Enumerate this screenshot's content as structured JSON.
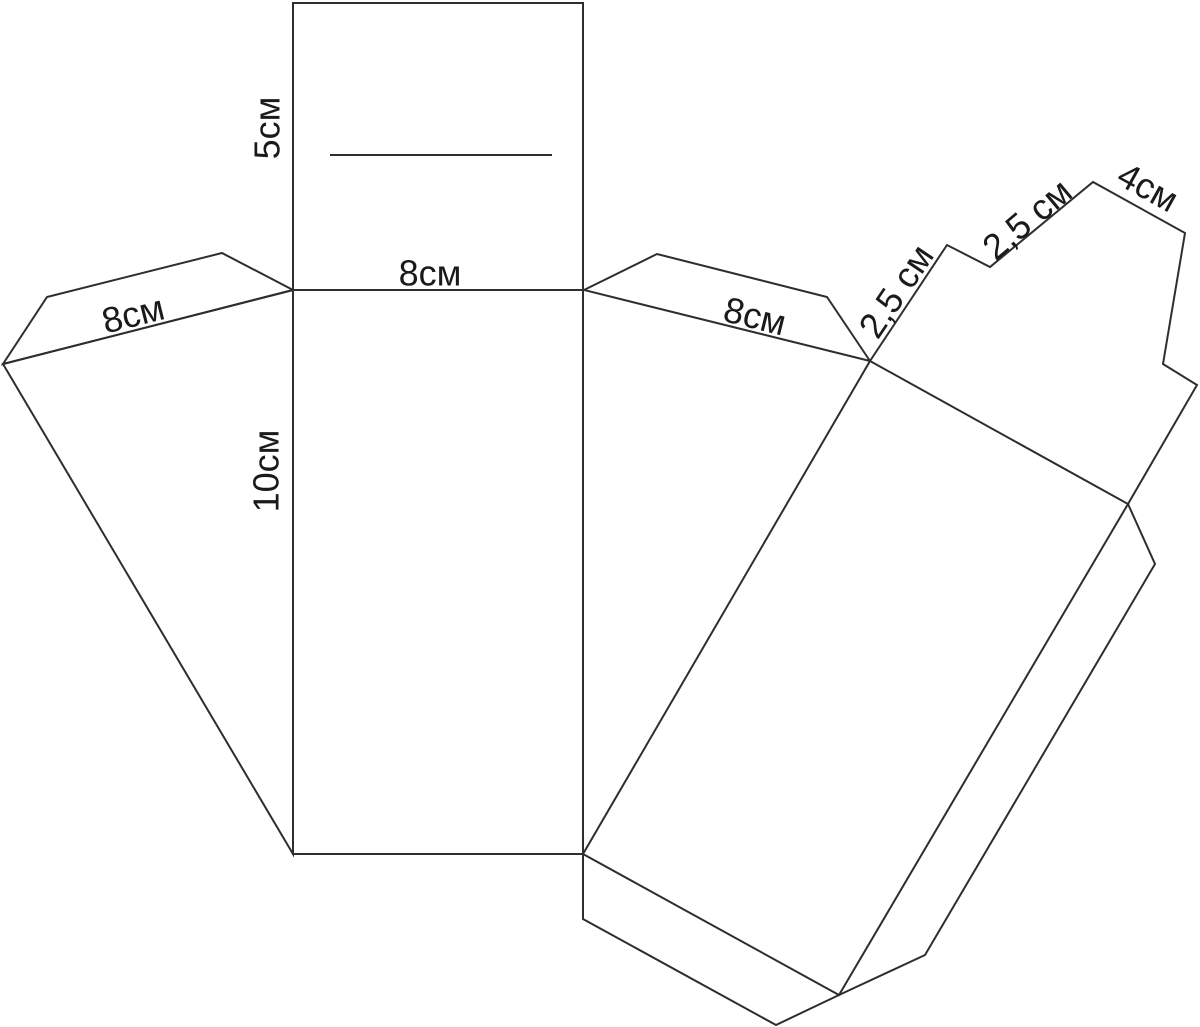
{
  "diagram": {
    "kind": "box-net-pattern",
    "background": "#ffffff"
  },
  "colors": {
    "line": "#2e2e2e",
    "text": "#1a1a1a"
  },
  "stroke_width": 2,
  "canvas": {
    "width": 1200,
    "height": 1027
  },
  "shapes": [
    {
      "name": "lid-panel",
      "type": "polygon",
      "points": [
        [
          293,
          3
        ],
        [
          583,
          3
        ],
        [
          583,
          290
        ],
        [
          293,
          290
        ]
      ]
    },
    {
      "name": "slot-line",
      "type": "polyline",
      "points": [
        [
          330,
          155
        ],
        [
          552,
          155
        ]
      ]
    },
    {
      "name": "front-panel",
      "type": "polygon",
      "points": [
        [
          293,
          290
        ],
        [
          583,
          290
        ],
        [
          583,
          854
        ],
        [
          293,
          854
        ]
      ]
    },
    {
      "name": "left-glue-flap",
      "type": "polygon",
      "points": [
        [
          293,
          290
        ],
        [
          222,
          253
        ],
        [
          47,
          297
        ],
        [
          3,
          364
        ]
      ]
    },
    {
      "name": "left-side-panel",
      "type": "polygon",
      "points": [
        [
          293,
          290
        ],
        [
          3,
          364
        ],
        [
          293,
          854
        ]
      ]
    },
    {
      "name": "right-glue-flap",
      "type": "polygon",
      "points": [
        [
          584,
          290
        ],
        [
          657,
          254
        ],
        [
          827,
          297
        ],
        [
          870,
          361
        ]
      ]
    },
    {
      "name": "back-panel",
      "type": "polygon",
      "points": [
        [
          870,
          361
        ],
        [
          1128,
          504
        ],
        [
          839,
          995
        ],
        [
          583,
          854
        ]
      ]
    },
    {
      "name": "top-edge-strip",
      "type": "polyline",
      "points": [
        [
          870,
          361
        ],
        [
          947,
          245
        ],
        [
          990,
          267
        ],
        [
          1093,
          182
        ],
        [
          1185,
          233
        ],
        [
          1163,
          364
        ],
        [
          1197,
          385
        ],
        [
          1128,
          504
        ]
      ]
    },
    {
      "name": "bottom-edge-strip",
      "type": "polyline",
      "points": [
        [
          1128,
          504
        ],
        [
          1155,
          564
        ],
        [
          925,
          955
        ],
        [
          839,
          995
        ]
      ]
    },
    {
      "name": "bottom-glue-flap",
      "type": "polyline",
      "points": [
        [
          583,
          854
        ],
        [
          583,
          919
        ],
        [
          776,
          1025
        ],
        [
          839,
          995
        ]
      ]
    }
  ],
  "labels": [
    {
      "name": "dim-lid-depth",
      "text": "5см",
      "x": 267,
      "y": 128,
      "rotate": -90,
      "font_size": 36
    },
    {
      "name": "dim-top-width",
      "text": "8см",
      "x": 430,
      "y": 273,
      "rotate": 0,
      "font_size": 36
    },
    {
      "name": "dim-left-flap",
      "text": "8см",
      "x": 133,
      "y": 314,
      "rotate": -14,
      "font_size": 36
    },
    {
      "name": "dim-panel-height",
      "text": "10см",
      "x": 266,
      "y": 471,
      "rotate": -90,
      "font_size": 36
    },
    {
      "name": "dim-right-flap",
      "text": "8см",
      "x": 755,
      "y": 316,
      "rotate": 14,
      "font_size": 36
    },
    {
      "name": "dim-strip-lower",
      "text": "2,5 см",
      "x": 896,
      "y": 291,
      "rotate": -56,
      "font_size": 36
    },
    {
      "name": "dim-strip-upper",
      "text": "2,5 см",
      "x": 1027,
      "y": 219,
      "rotate": -40,
      "font_size": 36
    },
    {
      "name": "dim-tab-width",
      "text": "4см",
      "x": 1148,
      "y": 187,
      "rotate": 29,
      "font_size": 36
    }
  ]
}
